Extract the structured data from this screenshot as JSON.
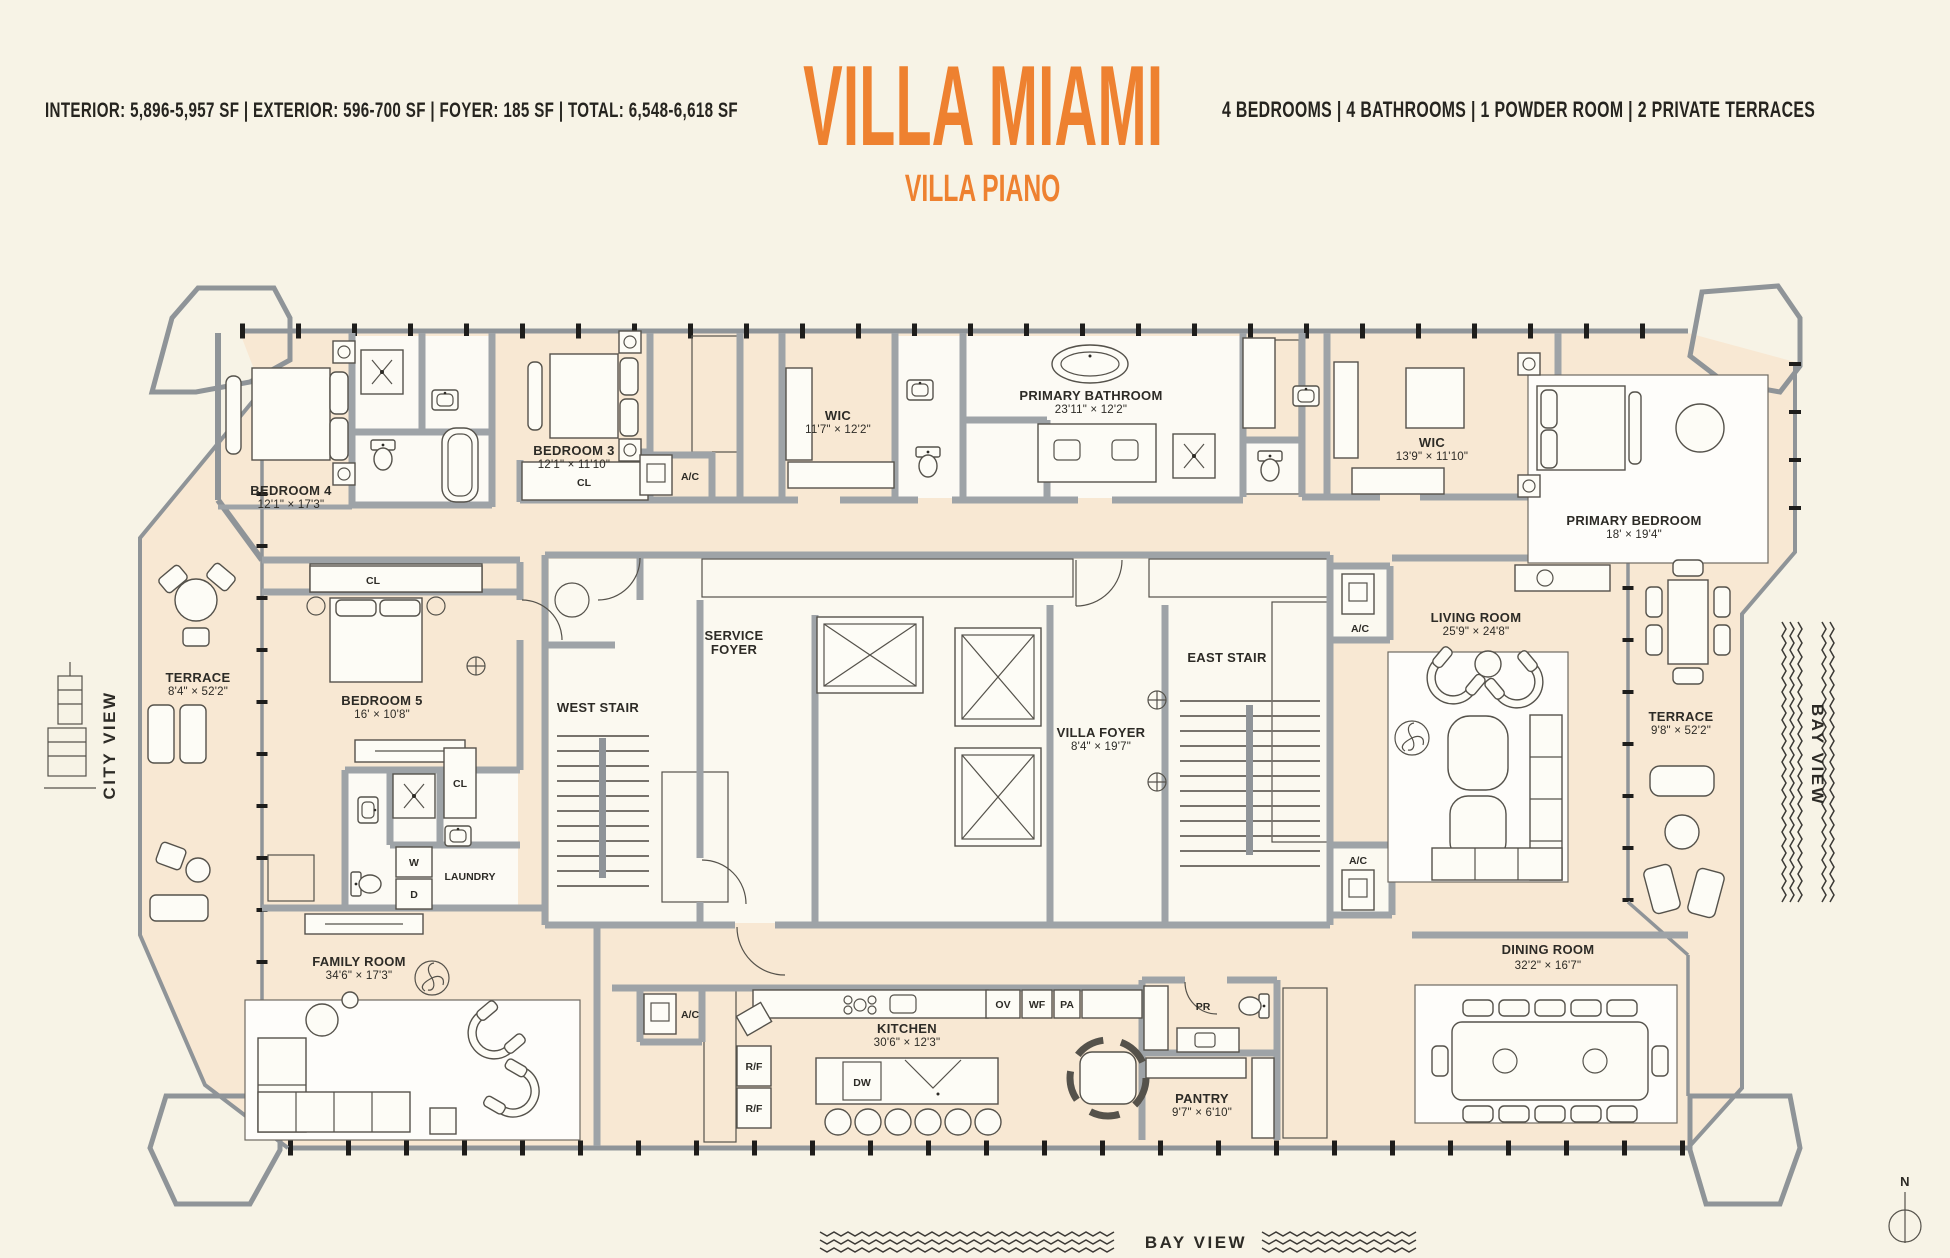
{
  "header": {
    "stats_left": "INTERIOR: 5,896-5,957 SF   |   EXTERIOR: 596-700 SF   |   FOYER: 185 SF   |   TOTAL: 6,548-6,618 SF",
    "title": "VILLA MIAMI",
    "subtitle": "VILLA PIANO",
    "stats_right": "4 BEDROOMS   |   4 BATHROOMS   |   1 POWDER ROOM   |   2 PRIVATE TERRACES"
  },
  "colors": {
    "accent_orange": "#EE8130",
    "background": "#F7F3E6",
    "floor_fill": "#F8E8D3",
    "wall_gray": "#9EA3A7",
    "text_dark": "#2D2B26"
  },
  "rooms": {
    "bedroom4": {
      "name": "BEDROOM 4",
      "dims": "12'1\" × 17'3\""
    },
    "bedroom3": {
      "name": "BEDROOM 3",
      "dims": "12'1\" × 11'10\""
    },
    "wic1": {
      "name": "WIC",
      "dims": "11'7\" × 12'2\""
    },
    "primary_bathroom": {
      "name": "PRIMARY BATHROOM",
      "dims": "23'11\" × 12'2\""
    },
    "wic2": {
      "name": "WIC",
      "dims": "13'9\" × 11'10\""
    },
    "primary_bedroom": {
      "name": "PRIMARY BEDROOM",
      "dims": "18' × 19'4\""
    },
    "terrace_left": {
      "name": "TERRACE",
      "dims": "8'4\" × 52'2\""
    },
    "bedroom5": {
      "name": "BEDROOM 5",
      "dims": "16' × 10'8\""
    },
    "service_foyer": {
      "line1": "SERVICE",
      "line2": "FOYER"
    },
    "west_stair": {
      "name": "WEST STAIR"
    },
    "east_stair": {
      "name": "EAST STAIR"
    },
    "villa_foyer": {
      "name": "VILLA FOYER",
      "dims": "8'4\" × 19'7\""
    },
    "living_room": {
      "name": "LIVING ROOM",
      "dims": "25'9\" × 24'8\""
    },
    "terrace_right": {
      "name": "TERRACE",
      "dims": "9'8\" × 52'2\""
    },
    "laundry": {
      "name": "LAUNDRY"
    },
    "family_room": {
      "name": "FAMILY ROOM",
      "dims": "34'6\" × 17'3\""
    },
    "kitchen": {
      "name": "KITCHEN",
      "dims": "30'6\" × 12'3\""
    },
    "pantry": {
      "name": "PANTRY",
      "dims": "9'7\" × 6'10\""
    },
    "powder_room": {
      "name": "PR"
    },
    "dining_room": {
      "name": "DINING ROOM",
      "dims": "32'2\" × 16'7\""
    }
  },
  "fixtures": {
    "closet": "CL",
    "ac": "A/C",
    "washer": "W",
    "dryer": "D",
    "rf": "R/F",
    "dw": "DW",
    "ov": "OV",
    "wf": "WF",
    "pa": "PA"
  },
  "views": {
    "city": "CITY VIEW",
    "bay": "BAY VIEW",
    "north": "N"
  }
}
